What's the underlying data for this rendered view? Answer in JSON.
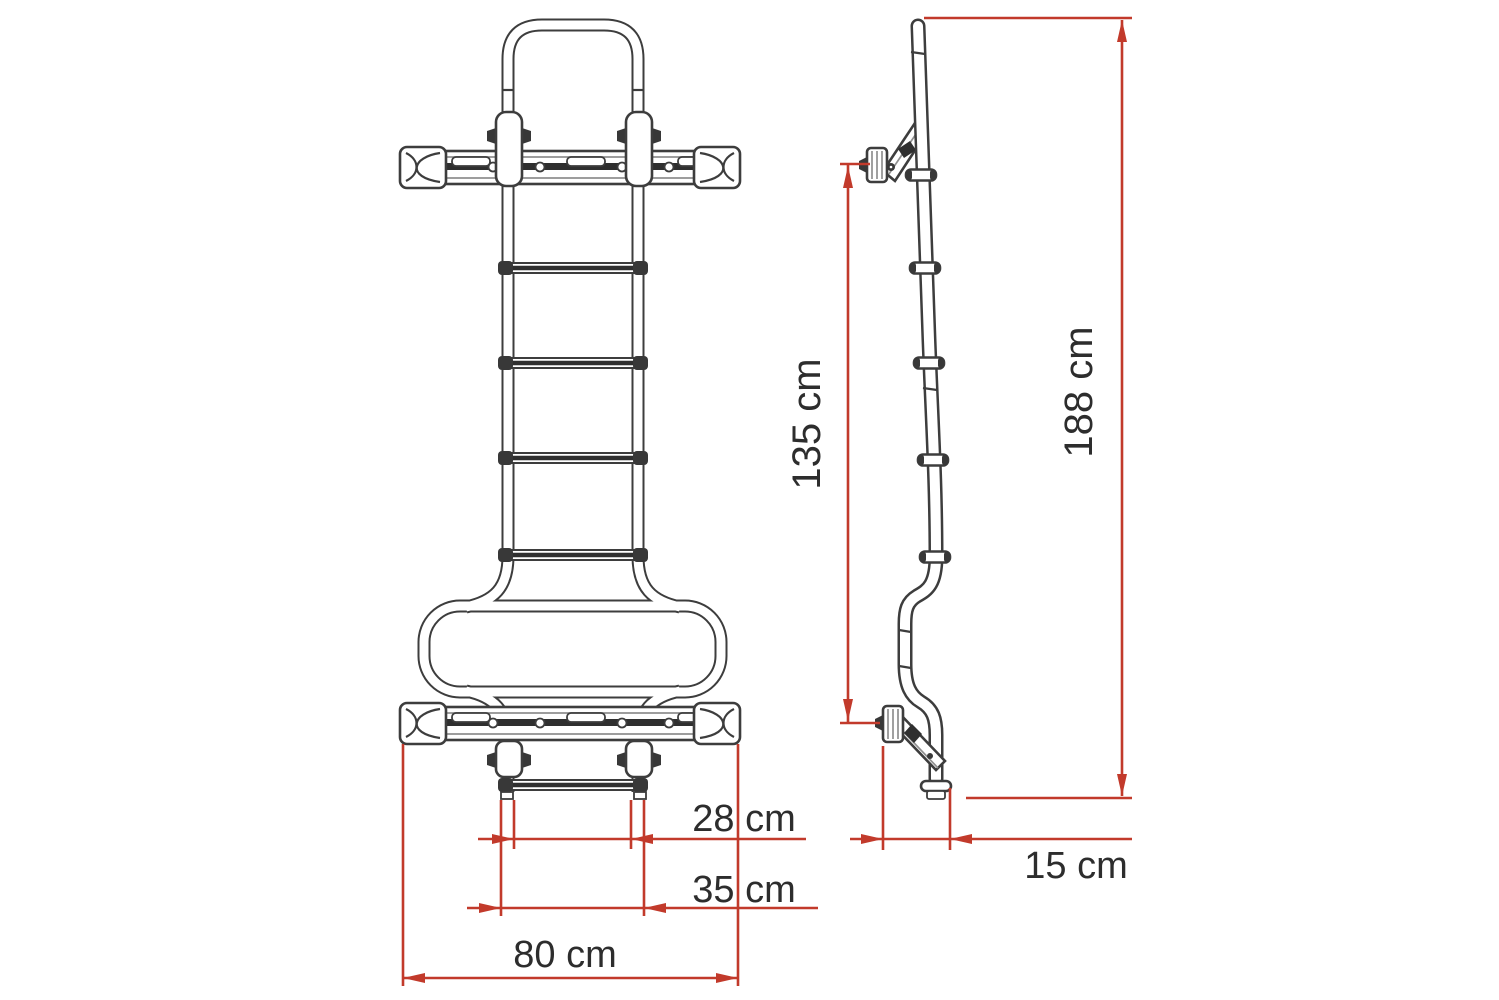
{
  "figure": {
    "description": "Technical dimension drawing of a vehicle roof ladder shown in front view and side view",
    "background": "#ffffff"
  },
  "colors": {
    "dimension_red": "#c23a2b",
    "drawing_outline": "#3d3d3d",
    "label_text": "#2d2d2d"
  },
  "views": {
    "front": {
      "name": "front view"
    },
    "side": {
      "name": "side view"
    }
  },
  "dimensions": {
    "front_view": [
      {
        "id": "rung-inner-width",
        "label": "28 cm"
      },
      {
        "id": "step-outer-width",
        "label": "35 cm"
      },
      {
        "id": "mounting-bar-width",
        "label": "80 cm"
      }
    ],
    "side_view": [
      {
        "id": "bracket-span",
        "label": "135 cm"
      },
      {
        "id": "overall-height",
        "label": "188 cm"
      },
      {
        "id": "wall-offset-depth",
        "label": "15 cm"
      }
    ]
  }
}
